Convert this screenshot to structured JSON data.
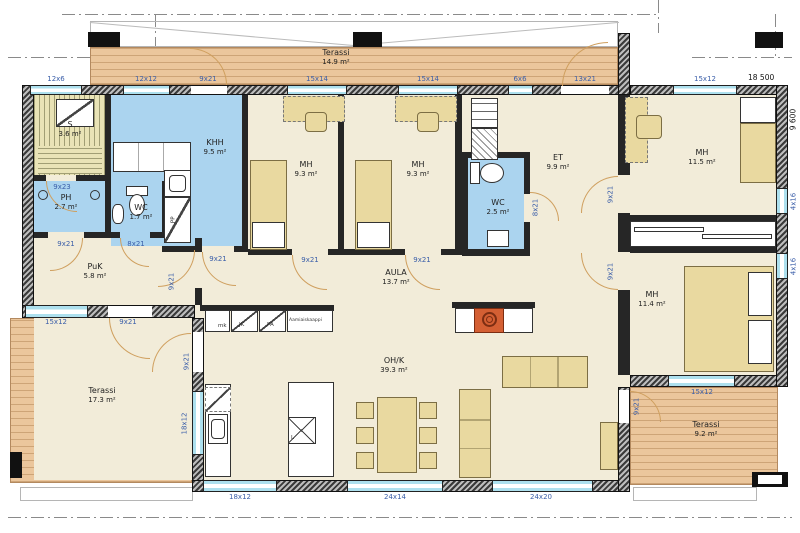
{
  "plan": {
    "type": "floor-plan",
    "language": "Finnish"
  },
  "rooms": {
    "terrace_top": {
      "name": "Terassi",
      "area": "14.9 m²"
    },
    "sauna": {
      "name": "S",
      "area": "3.6 m²"
    },
    "khh": {
      "name": "KHH",
      "area": "9.5 m²"
    },
    "ph": {
      "name": "PH",
      "area": "2.7 m²"
    },
    "wc1": {
      "name": "WC",
      "area": "1.7 m²"
    },
    "puk": {
      "name": "PuK",
      "area": "5.8 m²"
    },
    "mh1": {
      "name": "MH",
      "area": "9.3 m²"
    },
    "mh2": {
      "name": "MH",
      "area": "9.3 m²"
    },
    "wc2": {
      "name": "WC",
      "area": "2.5 m²"
    },
    "et": {
      "name": "ET",
      "area": "9.9 m²"
    },
    "mh3": {
      "name": "MH",
      "area": "11.5 m²"
    },
    "mh4": {
      "name": "MH",
      "area": "11.4 m²"
    },
    "aula": {
      "name": "AULA",
      "area": "13.7 m²"
    },
    "ohk": {
      "name": "OH/K",
      "area": "39.3 m²"
    },
    "terrace_left": {
      "name": "Terassi",
      "area": "17.3 m²"
    },
    "terrace_right": {
      "name": "Terassi",
      "area": "9.2 m²"
    }
  },
  "openings": {
    "top_w1": "12x6",
    "top_w2": "12x12",
    "top_d1": "9x21",
    "top_w3": "15x14",
    "top_w4": "15x14",
    "top_w5": "6x6",
    "top_d2": "13x21",
    "top_w6": "15x12",
    "right_w1": "4x16",
    "right_w2": "4x16",
    "bottom_w1": "18x12",
    "bottom_w2": "24x14",
    "bottom_w3": "24x20",
    "puk_w": "15x12",
    "puk_terrace_d": "9x21",
    "kitchen_w": "18x12",
    "ohk_west_d": "9x21",
    "mh4_w": "15x12",
    "ohk_east_d": "9x21",
    "sauna_d": "9x23",
    "ph_d": "9x21",
    "wc1_d": "8x21",
    "khh_d": "9x21",
    "puk_d": "9x21",
    "mh1_d": "9x21",
    "mh2_d": "9x21",
    "wc2_d": "8x21",
    "mh3_d": "9x21",
    "mh4_d": "9x21"
  },
  "fixtures": {
    "washing_machine": "PP",
    "microwave_cabinet": "mk",
    "fridge": "JK",
    "freezer": "PA",
    "breakfast_cabinet": "Aamiaiskaappi",
    "stove": "L"
  },
  "dimensions": {
    "overall_width": "18 500",
    "overall_height": "9 600"
  },
  "colors": {
    "wet_room": "#abd4ef",
    "deck_wood": "#ebc69c",
    "floor": "#f2ecd9",
    "furniture": "#e9d9a0",
    "opening_label": "#3a5ea9",
    "fireplace": "#d45f33"
  }
}
